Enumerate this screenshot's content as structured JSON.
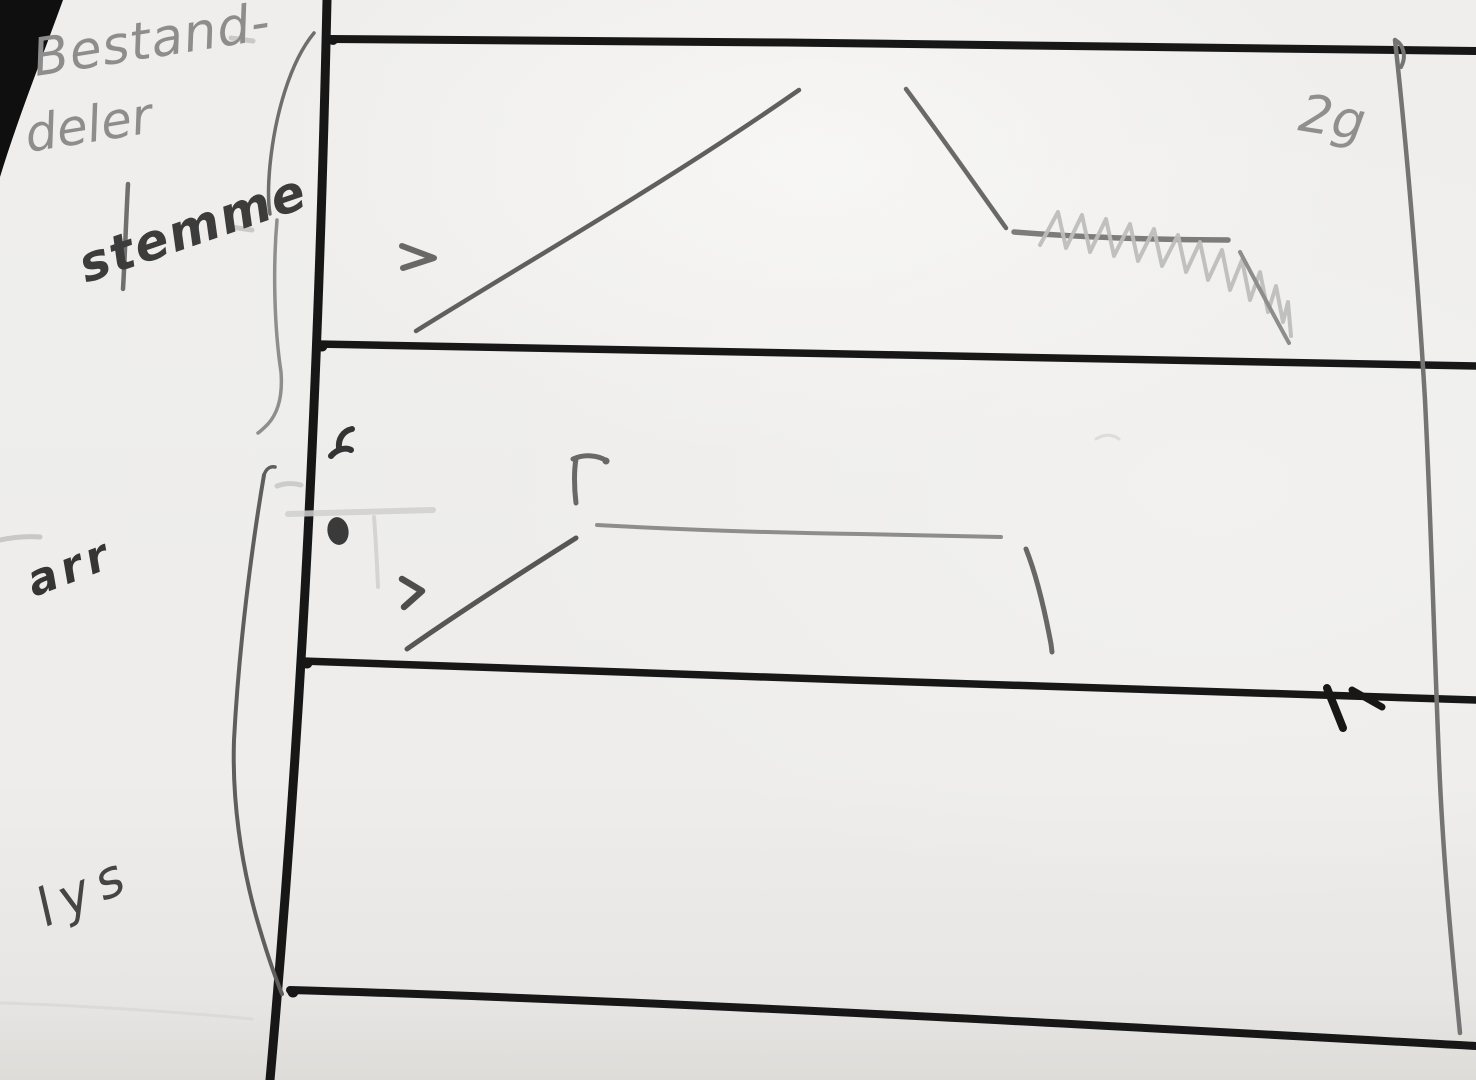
{
  "labels": {
    "heading_line1": "Bestand-",
    "heading_line2": "deler",
    "row1": "stemme",
    "row2": "arr",
    "row3": "lys",
    "corner_note": "2g"
  },
  "colors": {
    "paper": "#efeeec",
    "marker_black": "#171717",
    "pencil_dark": "#3a3a3a",
    "pencil_medium": "#6f6f6f",
    "pencil_light": "#8f8f8f",
    "pencil_faint": "#c6c6c6",
    "void_black": "#0f0f0f"
  }
}
